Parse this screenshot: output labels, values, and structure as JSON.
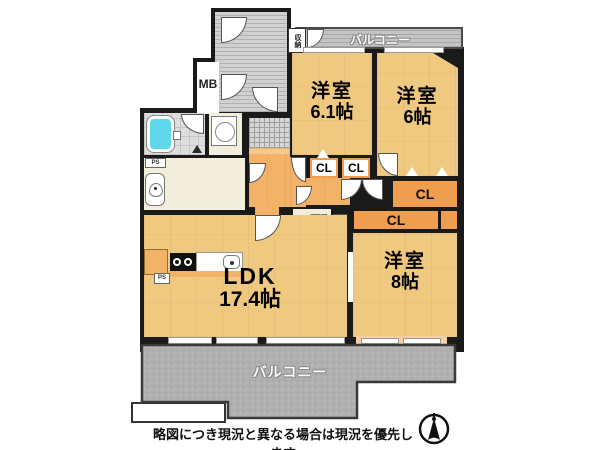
{
  "plan": {
    "rooms": [
      {
        "name": "洋室",
        "size": "6.1帖"
      },
      {
        "name": "洋室",
        "size": "6帖"
      },
      {
        "name": "洋室",
        "size": "8帖"
      },
      {
        "name": "LDK",
        "size": "17.4帖"
      }
    ],
    "closets": [
      "CL",
      "CL",
      "CL",
      "CL"
    ],
    "balcony_top": "バルコニー",
    "balcony_bottom": "バルコニー",
    "storage": "収納",
    "meter_box": "MB",
    "pipe_spaces": [
      "PS",
      "PS",
      "PS"
    ],
    "disclaimer": "略図につき現況と異なる場合は現況を優先します"
  },
  "colors": {
    "wall": "#1a1a1a",
    "room_floor": "#f0c981",
    "hall_floor": "#f2b268",
    "closet_orange": "#ef9d4f",
    "wet_area_cream": "#f2eedb",
    "balcony_gray": "#b0b0b0",
    "bathtub_cyan": "#5fd8ec",
    "background": "#ffffff"
  }
}
